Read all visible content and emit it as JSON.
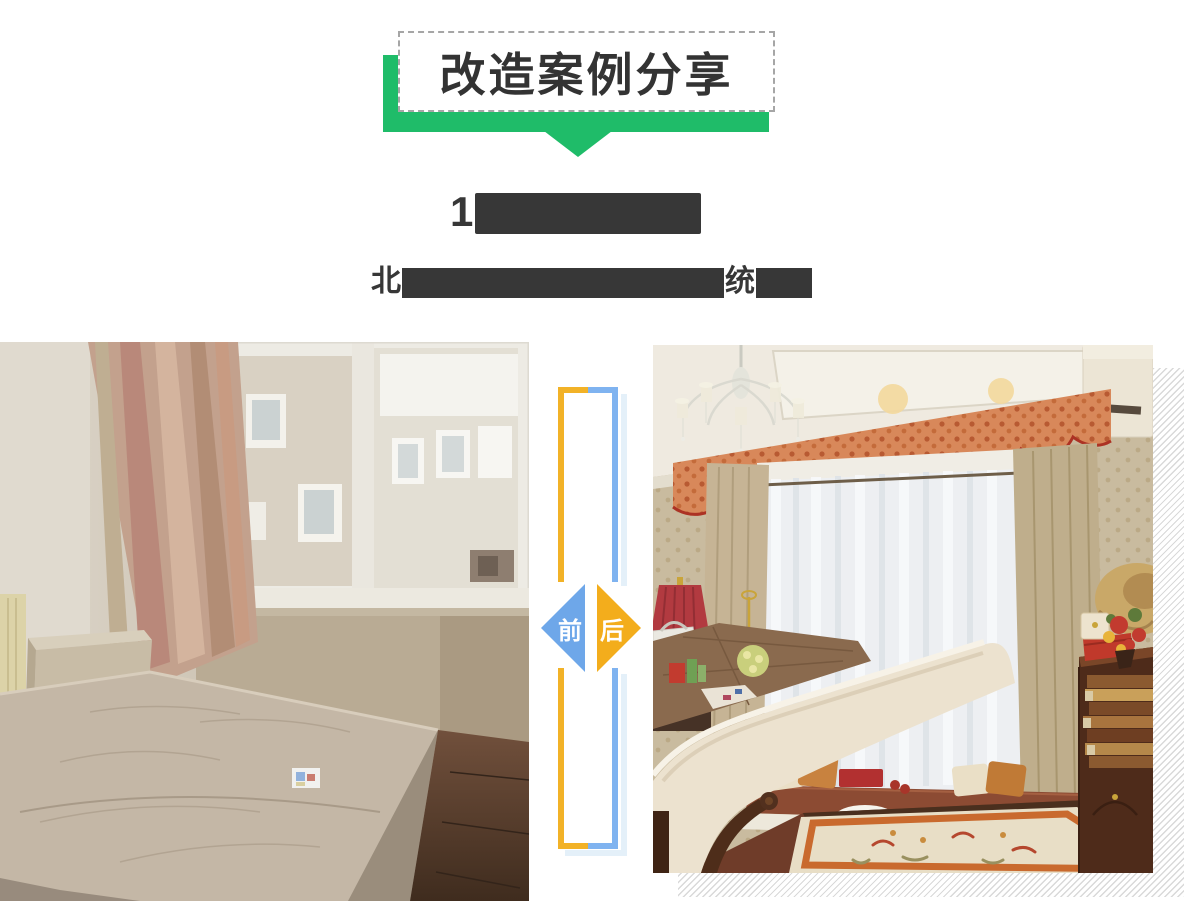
{
  "banner": {
    "title": "改造案例分享",
    "ribbon_color": "#1FBC69",
    "box_border_color": "#A6A6A6",
    "title_color": "#333333"
  },
  "case_title": {
    "redacted": true,
    "visible_prefix": "1",
    "bar_color": "#373737"
  },
  "case_subtitle": {
    "redacted": true,
    "fragment_left": "北",
    "fragment_right": "统",
    "bar_color": "#373737"
  },
  "comparison": {
    "before_label": "前",
    "after_label": "后",
    "before_badge_color": "#6EA7E9",
    "after_badge_color": "#F3AD1C",
    "frame_left_color": "#F2B227",
    "frame_right_color": "#7FB3F0",
    "frame_shadow_color": "#E4F0F9"
  },
  "decor": {
    "hatch_stripe_color": "#D9D9D9"
  }
}
